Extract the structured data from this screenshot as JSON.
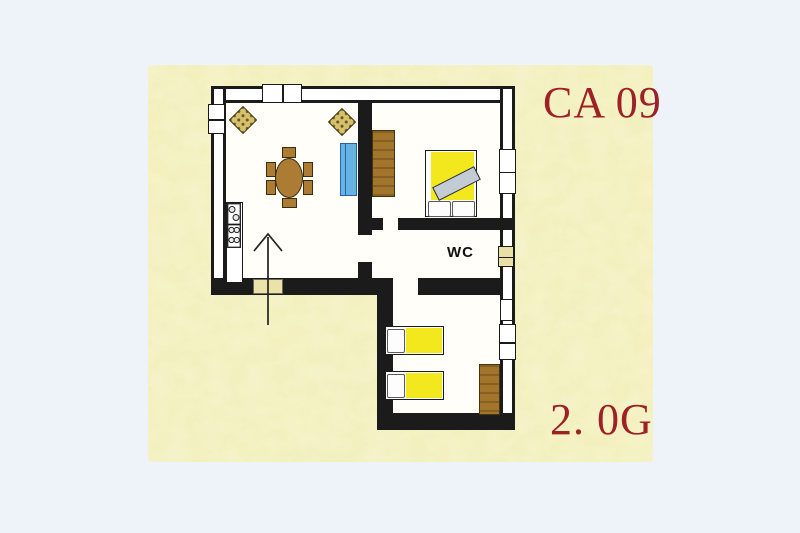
{
  "labels": {
    "unit_code": "CA 09",
    "floor_label": "2. 0G",
    "wc": "WC",
    "label_color": "#9d2125"
  },
  "palette": {
    "page_background": "#eef3f9",
    "texture_base": "#f4f1bd",
    "texture_mottle": "#e0db8c",
    "wall": "#1b1b1b",
    "room_floor": "#fffef9",
    "bed_yellow": "#f3e71d",
    "furniture_brown": "#ad7c34",
    "wardrobe_brown": "#a3752c",
    "sofa_blue": "#66b2e2",
    "blanket_gray": "#c3cbd4",
    "door_tan": "#eae2a8"
  },
  "symbols": [
    "entrance-arrow-icon",
    "entrance-door",
    "window",
    "dining-table",
    "chair",
    "sofa",
    "wicker-stool",
    "kitchen-sink",
    "stove",
    "kitchen-counter",
    "double-bed",
    "single-bed",
    "pillow",
    "folded-blanket",
    "wardrobe"
  ]
}
